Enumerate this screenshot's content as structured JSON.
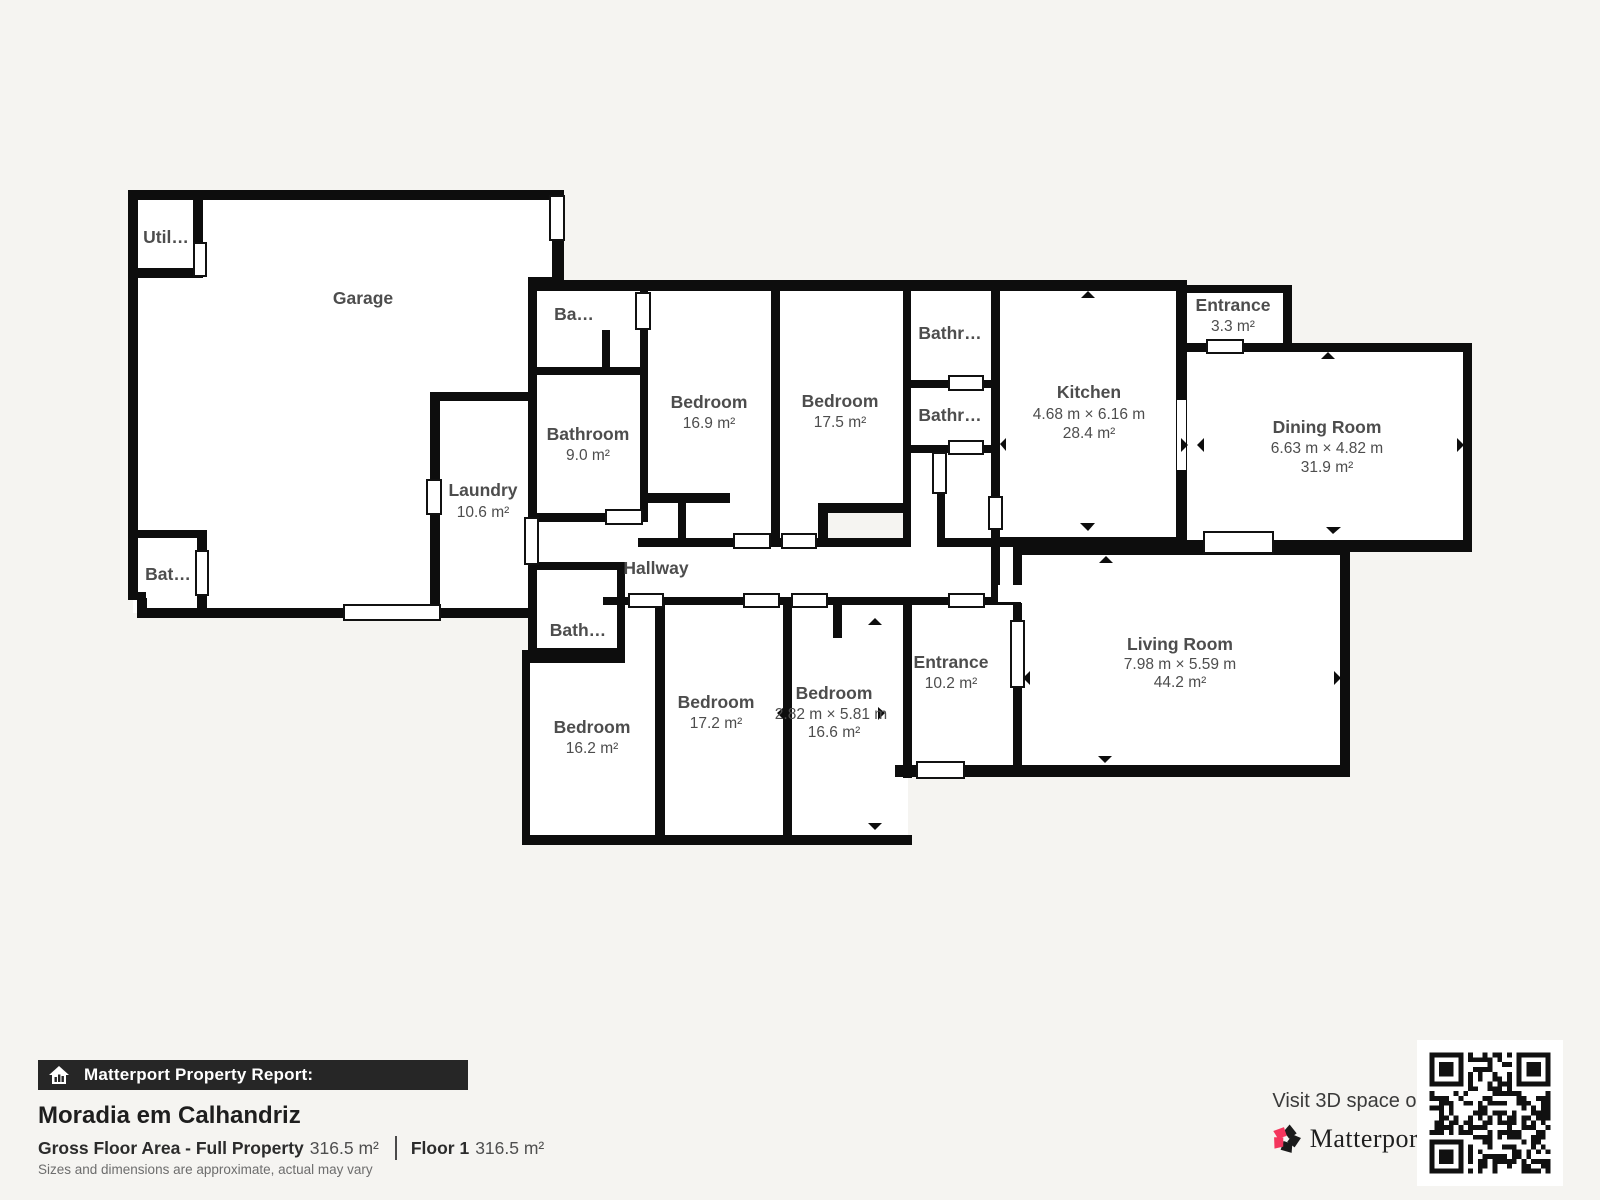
{
  "palette": {
    "background": "#f5f4f1",
    "wall": "#0d0d0d",
    "floor": "#ffffff",
    "label": "#4d4d4d",
    "bar_bg": "#262626",
    "brand_red": "#f4355d"
  },
  "rooms": {
    "utility": {
      "name": "Util…"
    },
    "garage": {
      "name": "Garage"
    },
    "bathroom_garage": {
      "name": "Bat…"
    },
    "laundry": {
      "name": "Laundry",
      "area": "10.6 m²"
    },
    "bathroom_top": {
      "name": "Ba…"
    },
    "bathroom_main": {
      "name": "Bathroom",
      "area": "9.0 m²"
    },
    "bedroom_1": {
      "name": "Bedroom",
      "area": "16.9 m²"
    },
    "bedroom_2": {
      "name": "Bedroom",
      "area": "17.5 m²"
    },
    "bathroom_small_upper": {
      "name": "Bathr…"
    },
    "bathroom_small_lower": {
      "name": "Bathr…"
    },
    "kitchen": {
      "name": "Kitchen",
      "dims": "4.68 m × 6.16 m",
      "area": "28.4 m²"
    },
    "entrance_top": {
      "name": "Entrance",
      "area": "3.3 m²"
    },
    "dining_room": {
      "name": "Dining Room",
      "dims": "6.63 m × 4.82 m",
      "area": "31.9 m²"
    },
    "hallway": {
      "name": "Hallway"
    },
    "bathroom_hall": {
      "name": "Bath…"
    },
    "bedroom_3": {
      "name": "Bedroom",
      "area": "16.2 m²"
    },
    "bedroom_4": {
      "name": "Bedroom",
      "area": "17.2 m²"
    },
    "bedroom_5": {
      "name": "Bedroom",
      "dims": "2.82 m × 5.81 m",
      "area": "16.6 m²"
    },
    "entrance_main": {
      "name": "Entrance",
      "area": "10.2 m²"
    },
    "living_room": {
      "name": "Living Room",
      "dims": "7.98 m × 5.59 m",
      "area": "44.2 m²"
    }
  },
  "report": {
    "bar_title": "Matterport Property Report:",
    "property_name": "Moradia em Calhandriz",
    "gross_floor_label": "Gross Floor Area - Full Property",
    "gross_floor_value": "316.5 m²",
    "floor_label": "Floor 1",
    "floor_value": "316.5 m²",
    "disclaimer": "Sizes and dimensions are approximate, actual may vary"
  },
  "promo": {
    "visit_text": "Visit 3D space on",
    "brand": "Matterport",
    "brand_mark": "ʼ"
  }
}
